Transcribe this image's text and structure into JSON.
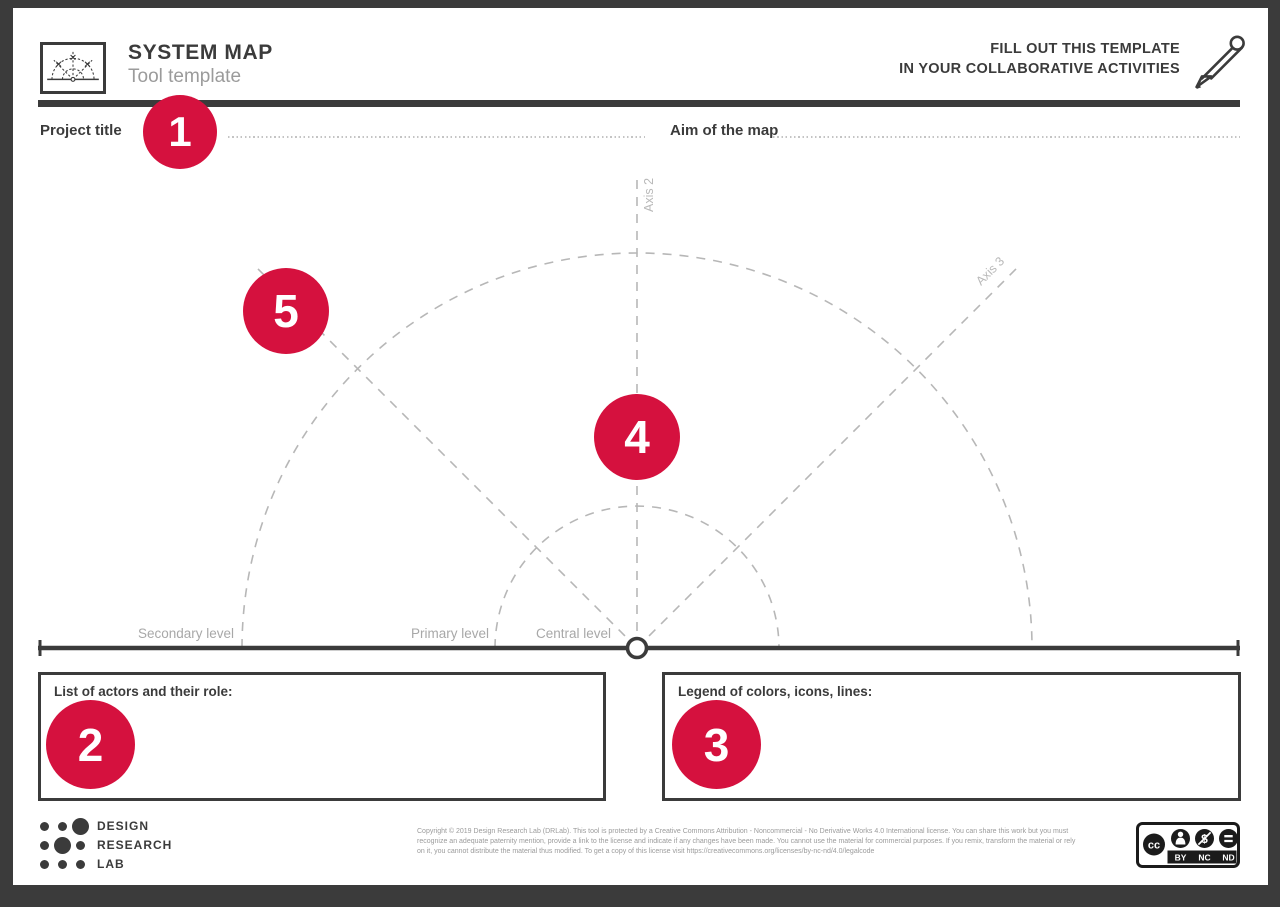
{
  "colors": {
    "accent": "#d5113e",
    "ink": "#3b3b3b",
    "muted": "#9b9b9b",
    "diagram_line": "#b7b7b7",
    "sheet": "#ffffff",
    "frame": "#3b3b3b"
  },
  "header": {
    "logo_icon": "system-map-mini-diagram",
    "title": "SYSTEM MAP",
    "subtitle": "Tool template",
    "cta_line1": "FILL OUT THIS TEMPLATE",
    "cta_line2": "IN YOUR COLLABORATIVE ACTIVITIES",
    "pencil_icon": "pencil-icon"
  },
  "fields": {
    "project_title": {
      "label": "Project title",
      "value": ""
    },
    "aim_of_map": {
      "label": "Aim of the map",
      "value": ""
    }
  },
  "steps": [
    "1",
    "2",
    "3",
    "4",
    "5"
  ],
  "diagram": {
    "axis_labels": [
      "Axis 1",
      "Axis 2",
      "Axis 3"
    ],
    "level_labels": [
      "Secondary level",
      "Primary level",
      "Central level"
    ]
  },
  "boxes": {
    "actors": {
      "label": "List of actors and their role:",
      "value": ""
    },
    "legend": {
      "label": "Legend of colors, icons, lines:",
      "value": ""
    }
  },
  "footer": {
    "brand_lines": [
      "DESIGN",
      "RESEARCH",
      "LAB"
    ],
    "copyright_line1": "Copyright © 2019 Design Research Lab (DRLab). This tool is protected by a Creative Commons Attribution - Noncommercial - No Derivative Works 4.0 International license. You can share this work but you must",
    "copyright_line2": "recognize an adequate paternity mention, provide a link to the license and indicate if any changes have been made. You cannot use the material for commercial purposes. If you remix, transform the material or rely",
    "copyright_line3": "on it, you cannot distribute the material thus modified. To get a copy of this license visit https://creativecommons.org/licenses/by-nc-nd/4.0/legalcode",
    "license_labels": [
      "BY",
      "NC",
      "ND"
    ],
    "license_cc_text": "cc"
  }
}
